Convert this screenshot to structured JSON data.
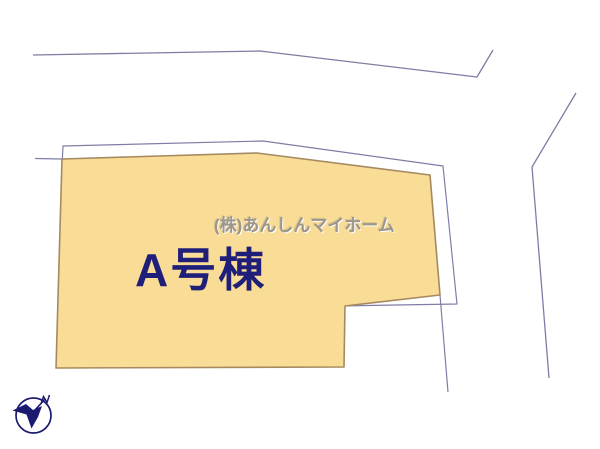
{
  "parcel": {
    "label": "A号棟",
    "fill_color": "#f9dc96",
    "outline_color": "#a58a60",
    "label_color": "#1f1f7a"
  },
  "watermark": {
    "text": "(株)あんしんマイホーム",
    "color": "#9c968b"
  },
  "boundary": {
    "line_color": "#7d7da6"
  },
  "compass": {
    "icon": "north-compass-icon",
    "color": "#1b1b6f"
  }
}
